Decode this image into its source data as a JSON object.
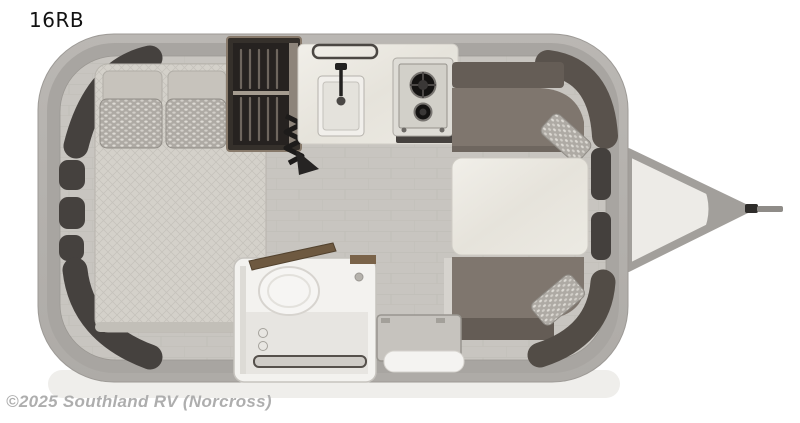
{
  "page": {
    "title": "16RB",
    "watermark": "©2025 Southland RV (Norcross)"
  },
  "floorplan": {
    "model": "16RB",
    "type": "travel-trailer-floorplan",
    "fixtures": [
      {
        "name": "bed",
        "note": "crosswise bed with two plain and two patterned pillows"
      },
      {
        "name": "wardrobe",
        "note": "dark closet with hanging clothes and shelf"
      },
      {
        "name": "kitchen-counter",
        "note": "marble countertop with towel bar"
      },
      {
        "name": "kitchen-sink",
        "note": "square basin with black faucet"
      },
      {
        "name": "cooktop",
        "note": "two-burner gas stove"
      },
      {
        "name": "bathroom",
        "note": "wet bath with toilet, drain and open wood door"
      },
      {
        "name": "dinette-table",
        "note": "marble top table"
      },
      {
        "name": "dinette-sofa",
        "note": "wrap-around benches with accent pillows"
      },
      {
        "name": "entry-step",
        "note": "entry door mat and exterior step"
      },
      {
        "name": "hitch",
        "note": "A-frame tongue with coupler"
      }
    ],
    "colors": {
      "shell": "#b5b2ae",
      "wall": "#a8a5a1",
      "floor": "#c8c5c0",
      "cabinet_dark": "#45413e",
      "mattress": "#d4d1ca",
      "pillow_accent": "#aeaaa4",
      "wardrobe": "#35302b",
      "counter": "#ebe8e1",
      "cooktop": "#dedcd6",
      "sofa": "#7f766e",
      "sofa_dark": "#59524c",
      "table": "#e9e6de",
      "bathroom": "#f3f2ef",
      "door_wood": "#6e5940",
      "hitch": "#a29f9b",
      "title_color": "#121212",
      "watermark_color": "#aeaeae"
    }
  }
}
